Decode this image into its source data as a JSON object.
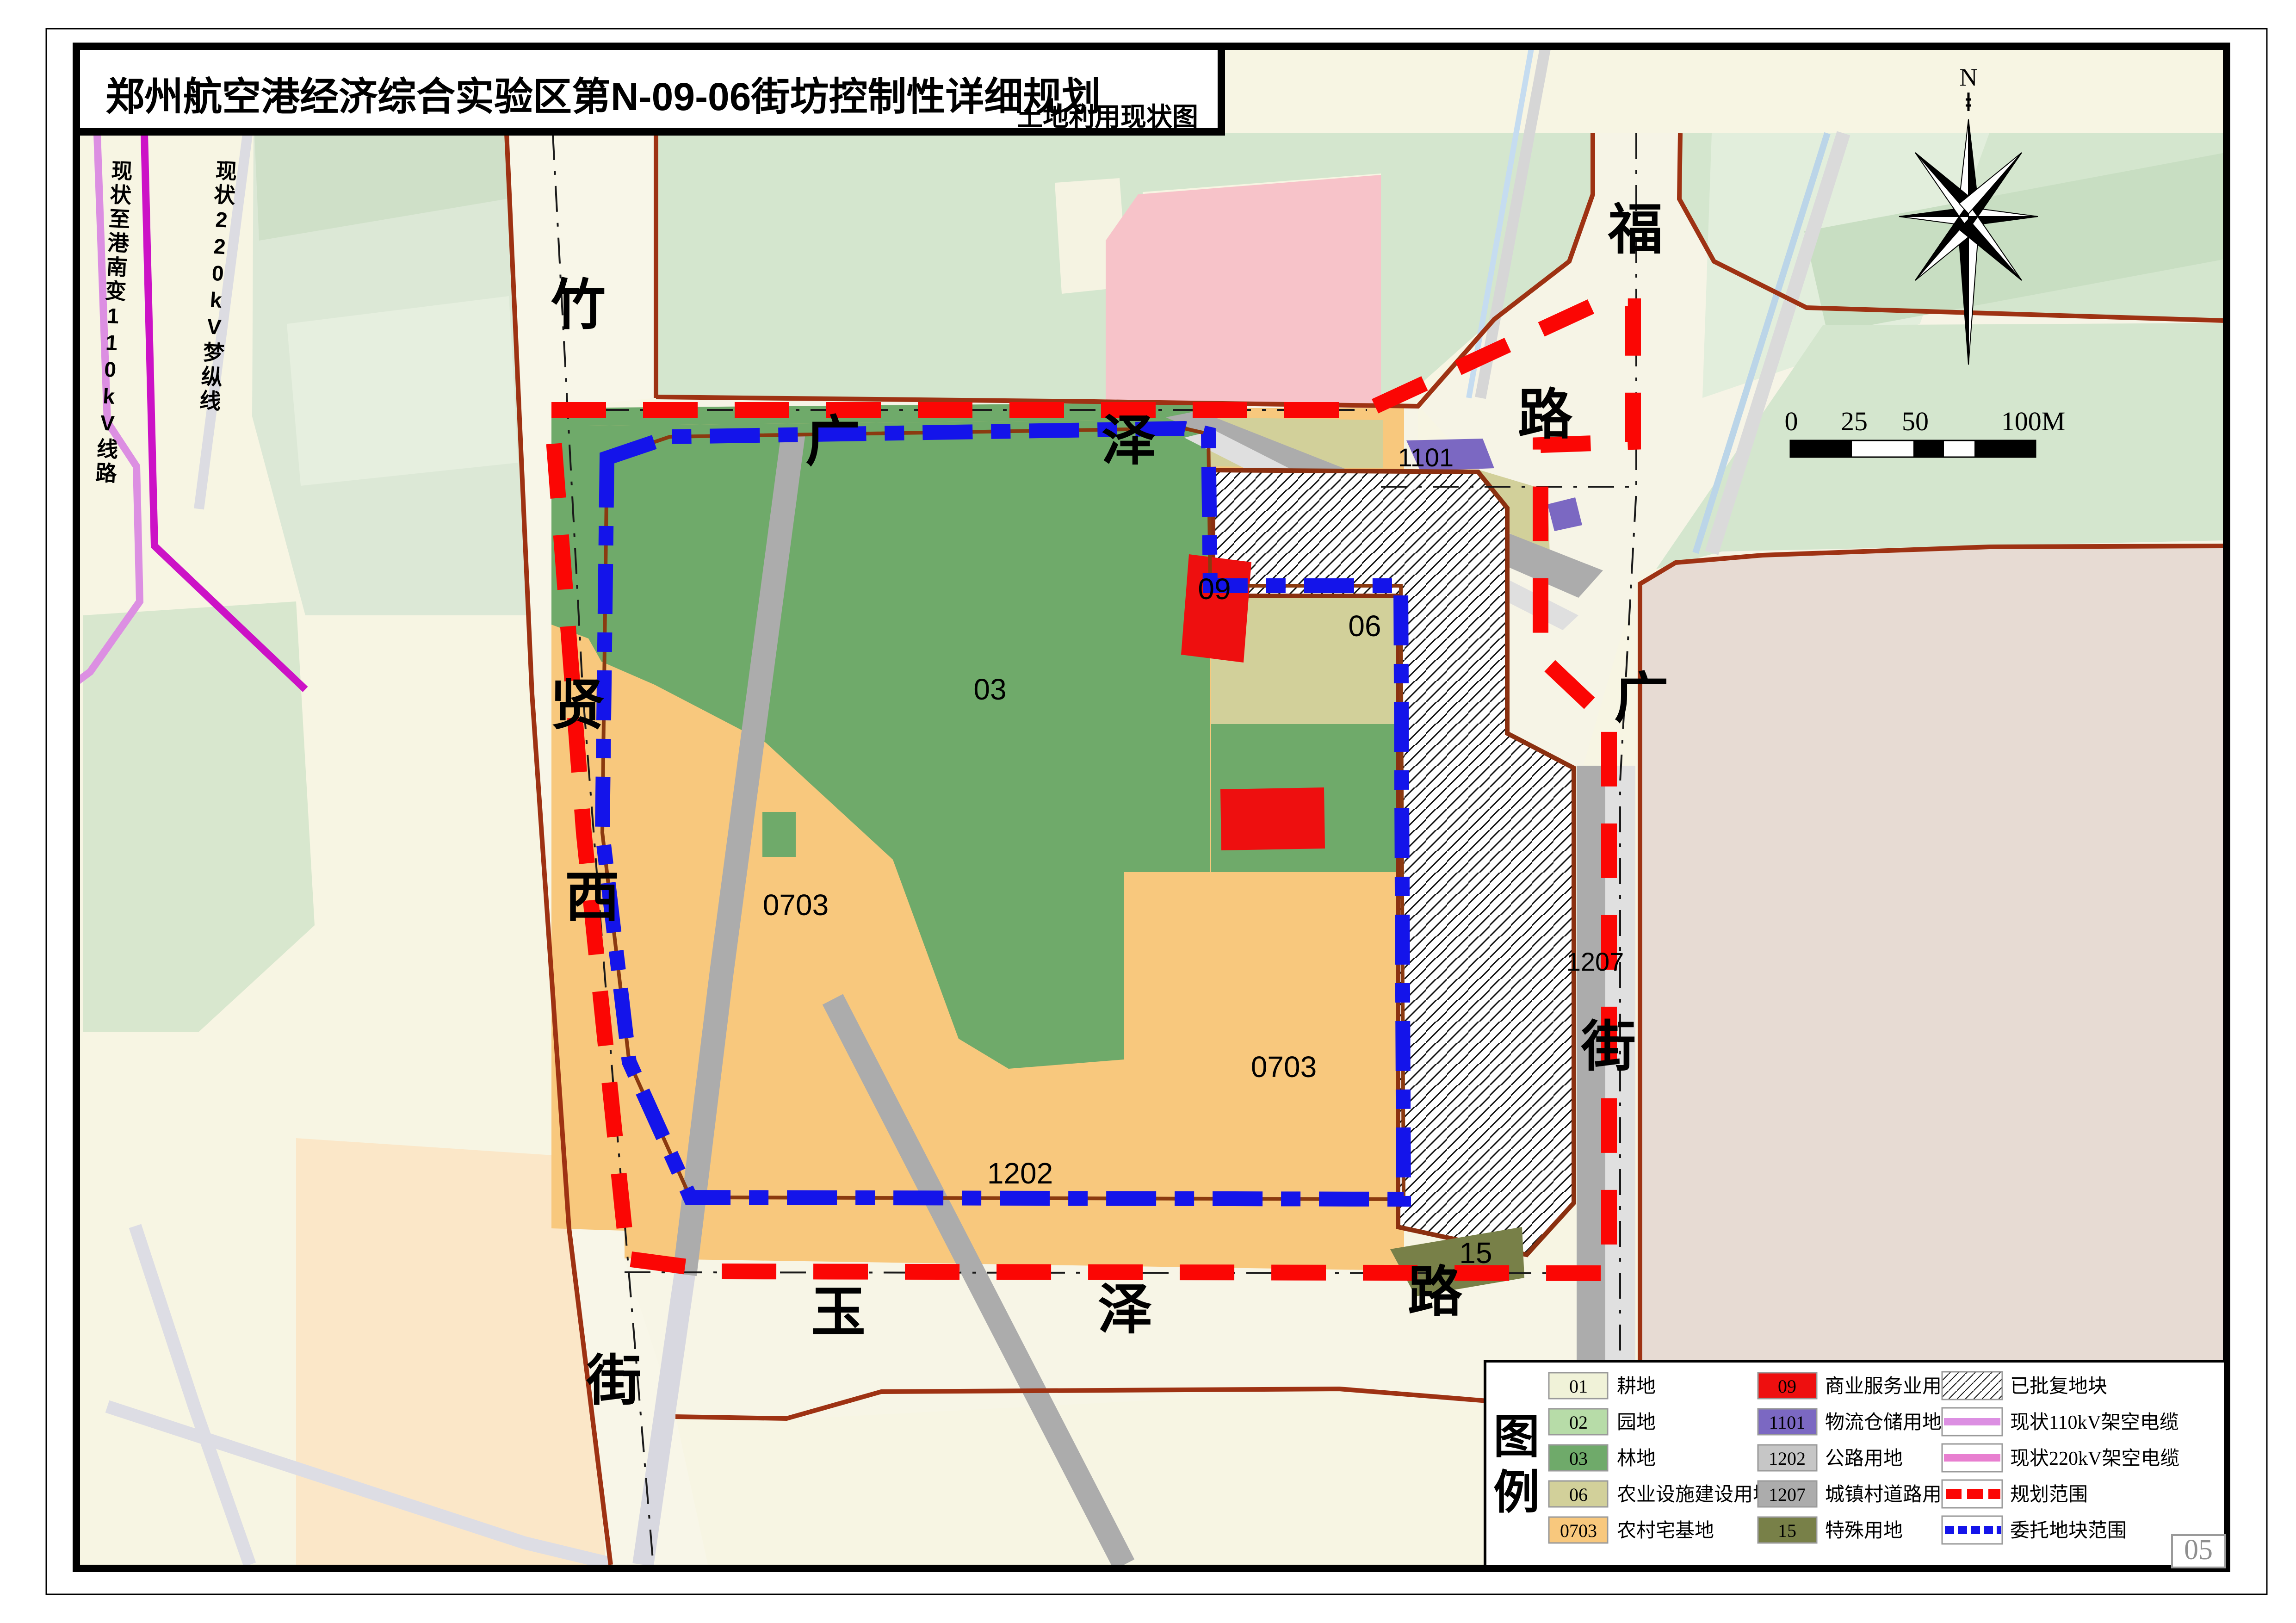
{
  "title_box": {
    "title": "郑州航空港经济综合实验区第N-09-06街坊控制性详细规划",
    "subtitle": "土地利用现状图"
  },
  "compass": {
    "north_label": "N"
  },
  "scale_bar": {
    "labels": [
      "0",
      "25",
      "50",
      "100M"
    ]
  },
  "page_number": "05",
  "power_lines": {
    "line110_label": "现状至港南变110kV线路",
    "line220_label": "现状220kV梦纵线",
    "line110_color": "#DC8FE2",
    "line220_color": "#CC12C6"
  },
  "roads": {
    "zhuxianxi": [
      "竹",
      "贤",
      "西",
      "街"
    ],
    "guangze": [
      "广",
      "泽",
      "路"
    ],
    "yuze": [
      "玉",
      "泽",
      "路"
    ],
    "fuguang": [
      "福",
      "广",
      "街"
    ]
  },
  "zones": {
    "z03": "03",
    "z09": "09",
    "z06": "06",
    "z0703_left": "0703",
    "z0703_right": "0703",
    "z1101": "1101",
    "z1202": "1202",
    "z1207": "1207",
    "z15": "15"
  },
  "legend": {
    "title_chars": [
      "图",
      "例"
    ],
    "col1": [
      {
        "code": "01",
        "label": "耕地",
        "color": "#F0F2D8"
      },
      {
        "code": "02",
        "label": "园地",
        "color": "#B7DCA8"
      },
      {
        "code": "03",
        "label": "林地",
        "color": "#6FAA6A"
      },
      {
        "code": "06",
        "label": "农业设施建设用地",
        "color": "#D2D09A"
      },
      {
        "code": "0703",
        "label": "农村宅基地",
        "color": "#F8C87D"
      }
    ],
    "col2": [
      {
        "code": "09",
        "label": "商业服务业用地",
        "color": "#EE0F0F"
      },
      {
        "code": "1101",
        "label": "物流仓储用地",
        "color": "#7B68C2"
      },
      {
        "code": "1202",
        "label": "公路用地",
        "color": "#C6C6C6"
      },
      {
        "code": "1207",
        "label": "城镇村道路用地",
        "color": "#ACACAC"
      },
      {
        "code": "15",
        "label": "特殊用地",
        "color": "#788048"
      }
    ],
    "col3": [
      {
        "label": "已批复地块",
        "type": "hatch"
      },
      {
        "label": "现状110kV架空电缆",
        "type": "line",
        "color": "#DC8FE2"
      },
      {
        "label": "现状220kV架空电缆",
        "type": "line",
        "color": "#E87FD0"
      },
      {
        "label": "规划范围",
        "type": "dash-red",
        "color": "#FB0604"
      },
      {
        "label": "委托地块范围",
        "type": "dash-blue",
        "color": "#1414EA"
      }
    ]
  },
  "map_colors": {
    "background_cream": "#F7F5E3",
    "pale_green": "#D4E6CE",
    "pink_block": "#F7C3C9",
    "beige_parcel": "#E7DBD3",
    "planning_boundary_red": "#FB0604",
    "delegate_boundary_blue": "#1414EA",
    "road_edge_brown": "#9E3213"
  }
}
